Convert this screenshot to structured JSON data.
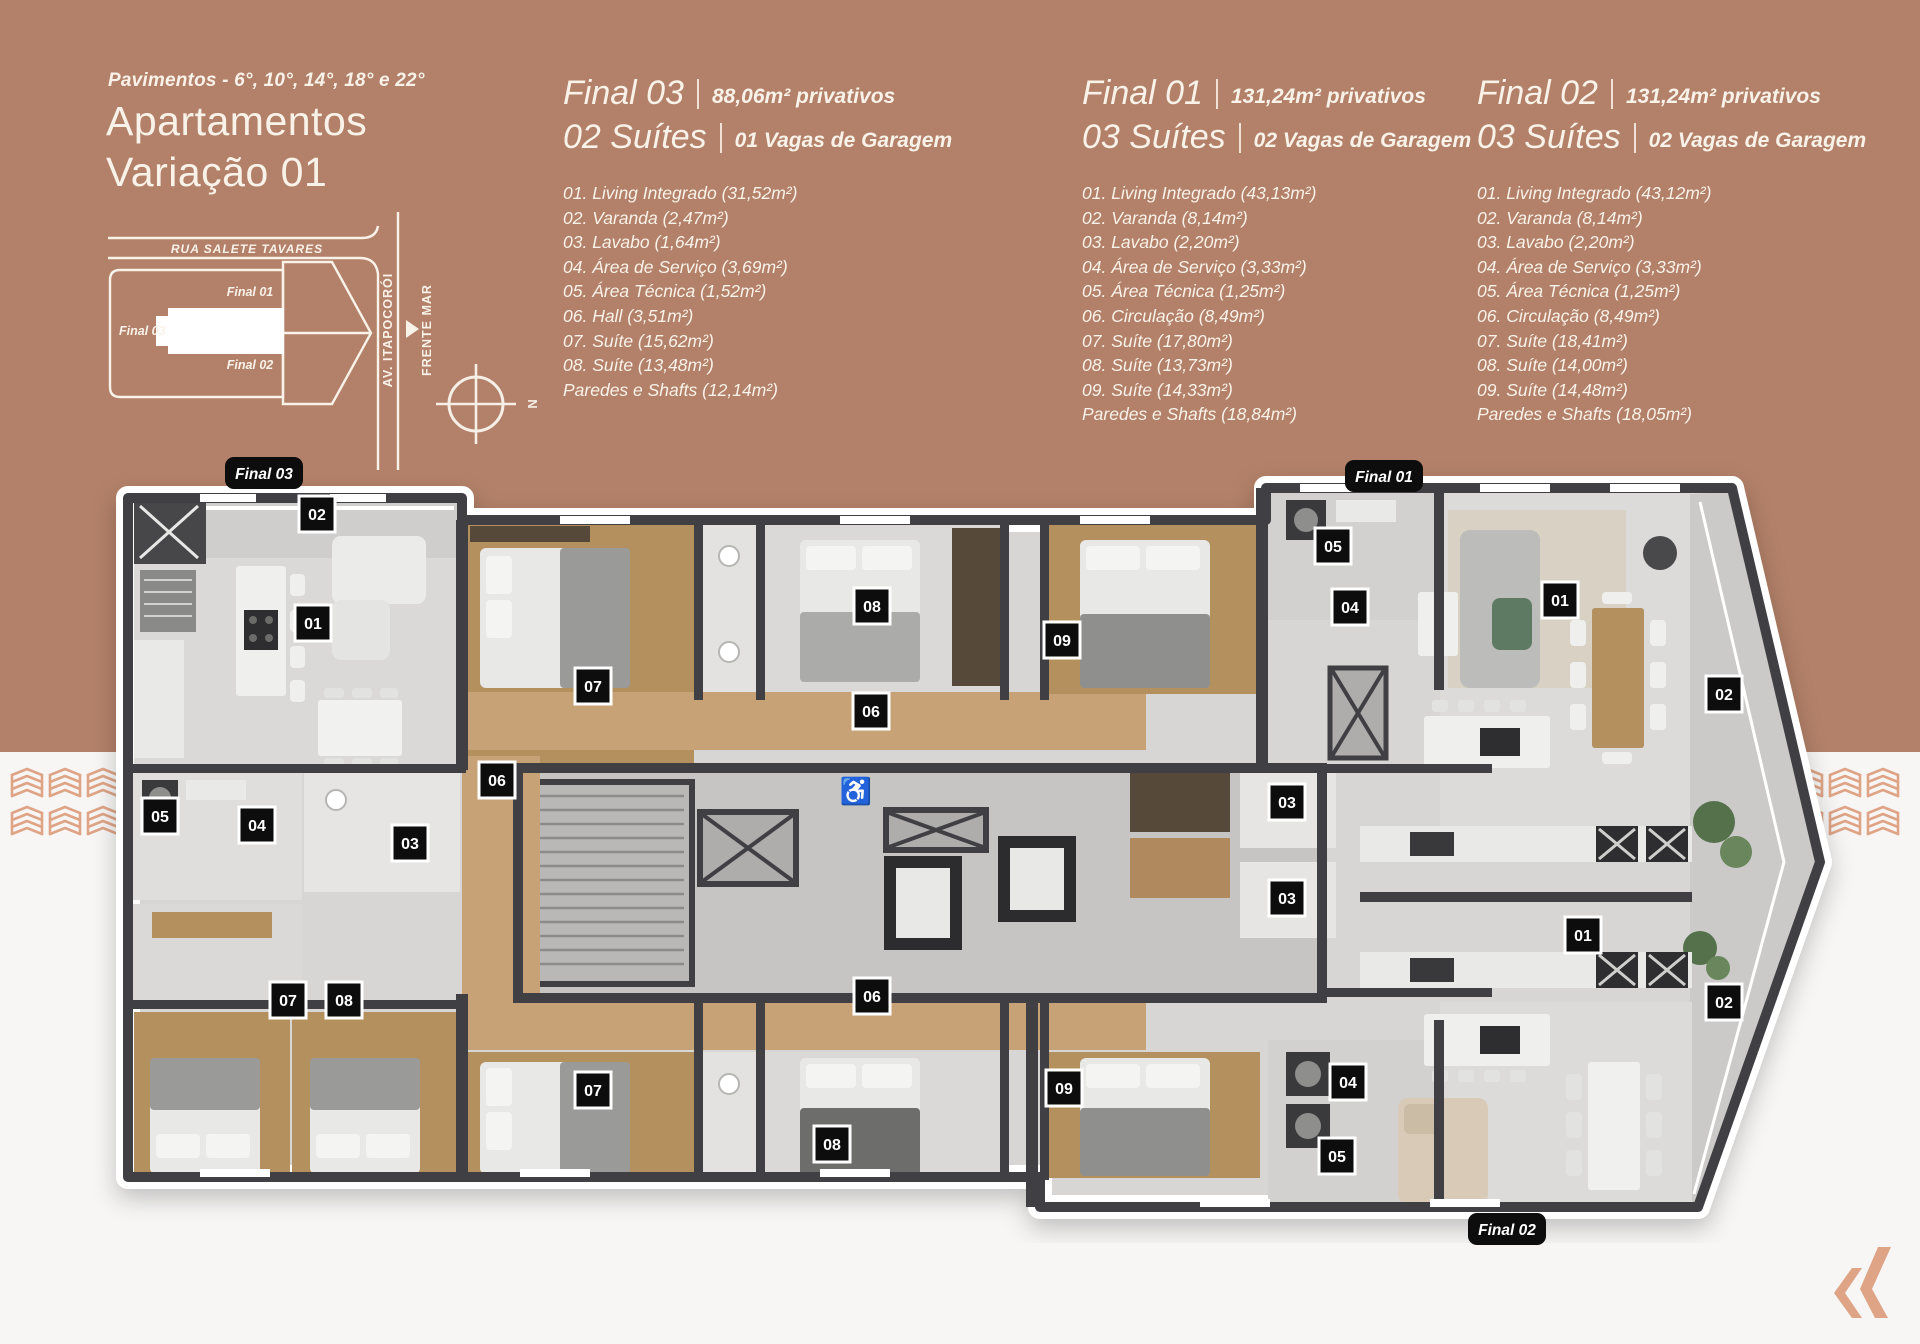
{
  "colors": {
    "band": "#b38169",
    "cream_text": "#f9f2e9",
    "tag_black": "#0d0d0d",
    "logo_accent": "#dfa486",
    "plan_wall": "#404044",
    "plan_floor": "#d7d6d4",
    "plan_wood": "#b4905f"
  },
  "header": {
    "floors_label": "Pavimentos - 6°, 10°, 14°, 18° e 22°",
    "title_line1": "Apartamentos",
    "title_line2": "Variação 01"
  },
  "site_map": {
    "street_top": "RUA SALETE TAVARES",
    "street_right": "AV. ITAPOCORÓI",
    "sea_label": "FRENTE MAR",
    "final_01": "Final 01",
    "final_03": "Final 03",
    "final_02": "Final 02",
    "compass_label": "N"
  },
  "units": [
    {
      "name": "Final 03",
      "area": "88,06m² privativos",
      "suites": "02 Suítes",
      "parking": "01 Vagas de Garagem",
      "items": [
        "01. Living Integrado (31,52m²)",
        "02. Varanda (2,47m²)",
        "03. Lavabo (1,64m²)",
        "04. Área de Serviço (3,69m²)",
        "05. Área Técnica (1,52m²)",
        "06. Hall (3,51m²)",
        "07. Suíte (15,62m²)",
        "08. Suíte (13,48m²)",
        "Paredes e Shafts (12,14m²)"
      ]
    },
    {
      "name": "Final 01",
      "area": "131,24m² privativos",
      "suites": "03 Suítes",
      "parking": "02 Vagas de Garagem",
      "items": [
        "01. Living Integrado (43,13m²)",
        "02. Varanda (8,14m²)",
        "03. Lavabo (2,20m²)",
        "04. Área de Serviço (3,33m²)",
        "05. Área Técnica (1,25m²)",
        "06. Circulação (8,49m²)",
        "07. Suíte (17,80m²)",
        "08. Suíte (13,73m²)",
        "09. Suíte (14,33m²)",
        "Paredes e Shafts (18,84m²)"
      ]
    },
    {
      "name": "Final 02",
      "area": "131,24m² privativos",
      "suites": "03 Suítes",
      "parking": "02 Vagas de Garagem",
      "items": [
        "01. Living Integrado (43,12m²)",
        "02. Varanda (8,14m²)",
        "03. Lavabo (2,20m²)",
        "04. Área de Serviço (3,33m²)",
        "05. Área Técnica (1,25m²)",
        "06. Circulação (8,49m²)",
        "07. Suíte (18,41m²)",
        "08. Suíte (14,00m²)",
        "09. Suíte (14,48m²)",
        "Paredes e Shafts (18,05m²)"
      ]
    }
  ],
  "plan": {
    "unit_tags": [
      {
        "label": "Final 03",
        "x": 264,
        "y": 473
      },
      {
        "label": "Final 01",
        "x": 1384,
        "y": 476
      },
      {
        "label": "Final 02",
        "x": 1507,
        "y": 1229
      }
    ],
    "room_tags": [
      {
        "label": "02",
        "x": 317,
        "y": 514
      },
      {
        "label": "01",
        "x": 313,
        "y": 623
      },
      {
        "label": "07",
        "x": 593,
        "y": 686
      },
      {
        "label": "08",
        "x": 872,
        "y": 606
      },
      {
        "label": "06",
        "x": 871,
        "y": 711
      },
      {
        "label": "09",
        "x": 1062,
        "y": 640
      },
      {
        "label": "05",
        "x": 1333,
        "y": 546
      },
      {
        "label": "04",
        "x": 1350,
        "y": 607
      },
      {
        "label": "01",
        "x": 1560,
        "y": 600
      },
      {
        "label": "02",
        "x": 1724,
        "y": 694
      },
      {
        "label": "06",
        "x": 497,
        "y": 780
      },
      {
        "label": "05",
        "x": 160,
        "y": 816
      },
      {
        "label": "04",
        "x": 257,
        "y": 825
      },
      {
        "label": "03",
        "x": 410,
        "y": 843
      },
      {
        "label": "03",
        "x": 1287,
        "y": 802
      },
      {
        "label": "03",
        "x": 1287,
        "y": 898
      },
      {
        "label": "01",
        "x": 1583,
        "y": 935
      },
      {
        "label": "07",
        "x": 288,
        "y": 1000
      },
      {
        "label": "08",
        "x": 344,
        "y": 1000
      },
      {
        "label": "06",
        "x": 872,
        "y": 996
      },
      {
        "label": "07",
        "x": 593,
        "y": 1090
      },
      {
        "label": "08",
        "x": 832,
        "y": 1144
      },
      {
        "label": "09",
        "x": 1064,
        "y": 1088
      },
      {
        "label": "04",
        "x": 1348,
        "y": 1082
      },
      {
        "label": "05",
        "x": 1337,
        "y": 1156
      },
      {
        "label": "02",
        "x": 1724,
        "y": 1002
      }
    ]
  }
}
